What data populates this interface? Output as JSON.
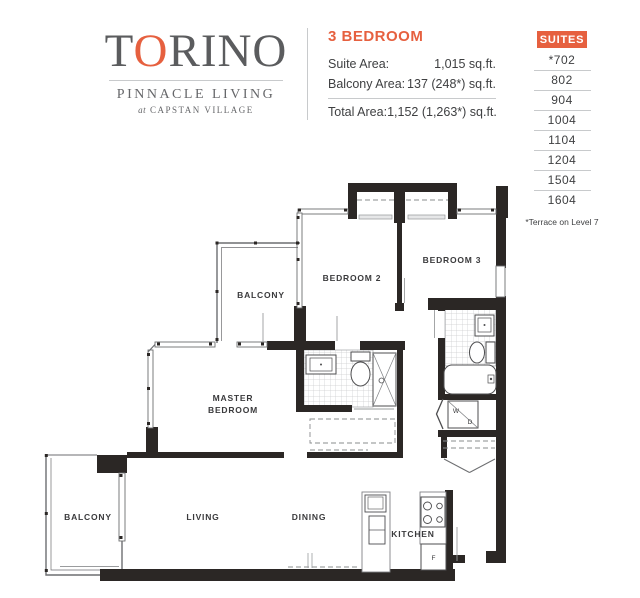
{
  "logo": {
    "name_part1": "T",
    "name_accent": "O",
    "name_part2": "RINO",
    "subtitle": "PINNACLE LIVING",
    "tagline_pre": "at",
    "tagline": "CAPSTAN VILLAGE"
  },
  "plan_info": {
    "title": "3 BEDROOM",
    "rows": [
      {
        "label": "Suite Area:",
        "value": "1,015 sq.ft."
      },
      {
        "label": "Balcony Area:",
        "value": "137 (248*) sq.ft."
      },
      {
        "label": "Total Area:",
        "value": "1,152 (1,263*) sq.ft."
      }
    ]
  },
  "suites": {
    "header": "SUITES",
    "numbers": [
      "*702",
      "802",
      "904",
      "1004",
      "1104",
      "1204",
      "1504",
      "1604"
    ],
    "footnote": "*Terrace on Level 7"
  },
  "floorplan": {
    "rooms": {
      "balcony_upper": "BALCONY",
      "bedroom2": "BEDROOM 2",
      "bedroom3": "BEDROOM 3",
      "master_line1": "MASTER",
      "master_line2": "BEDROOM",
      "balcony_lower": "BALCONY",
      "living": "LIVING",
      "dining": "DINING",
      "kitchen": "KITCHEN"
    },
    "fixtures": {
      "washer": "W",
      "dryer": "D",
      "fridge": "F"
    }
  },
  "colors": {
    "accent": "#E6603F",
    "wall": "#2B2725",
    "text_dark": "#3F4042",
    "logo_gray": "#5B5C5E",
    "divider": "#C8CACC"
  }
}
